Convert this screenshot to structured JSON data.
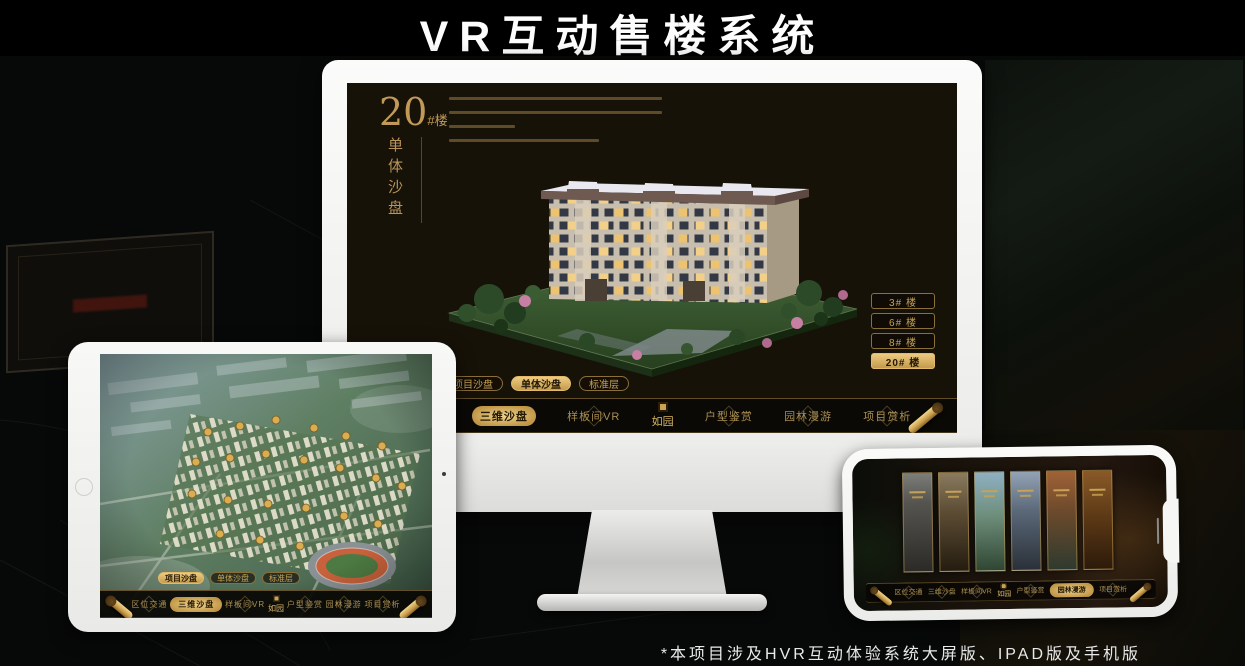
{
  "page": {
    "title": "VR互动售楼系统",
    "footnote": "*本项目涉及HVR互动体验系统大屏版、IPAD版及手机版"
  },
  "app": {
    "headline": {
      "number": "20",
      "suffix": "#楼",
      "title": "单体沙盘"
    },
    "floor_buttons": [
      "3# 楼",
      "6# 楼",
      "8# 楼",
      "20# 楼"
    ],
    "active_floor": "20# 楼",
    "view_tabs": [
      "项目沙盘",
      "单体沙盘",
      "标准层"
    ],
    "monitor_active_tab": "单体沙盘",
    "tablet_active_tab": "项目沙盘",
    "nav_left": [
      "区位交通",
      "三维沙盘",
      "样板间VR"
    ],
    "nav_right": [
      "户型鉴赏",
      "园林漫游",
      "项目赏析"
    ],
    "active_nav": "三维沙盘",
    "logo": "如园"
  },
  "colors": {
    "gold": "#c9a254",
    "gold_bright": "#ecca80",
    "screen_bg": "#171208",
    "nav_bg": "#0b0906",
    "frame_white": "#f2f2f0"
  }
}
